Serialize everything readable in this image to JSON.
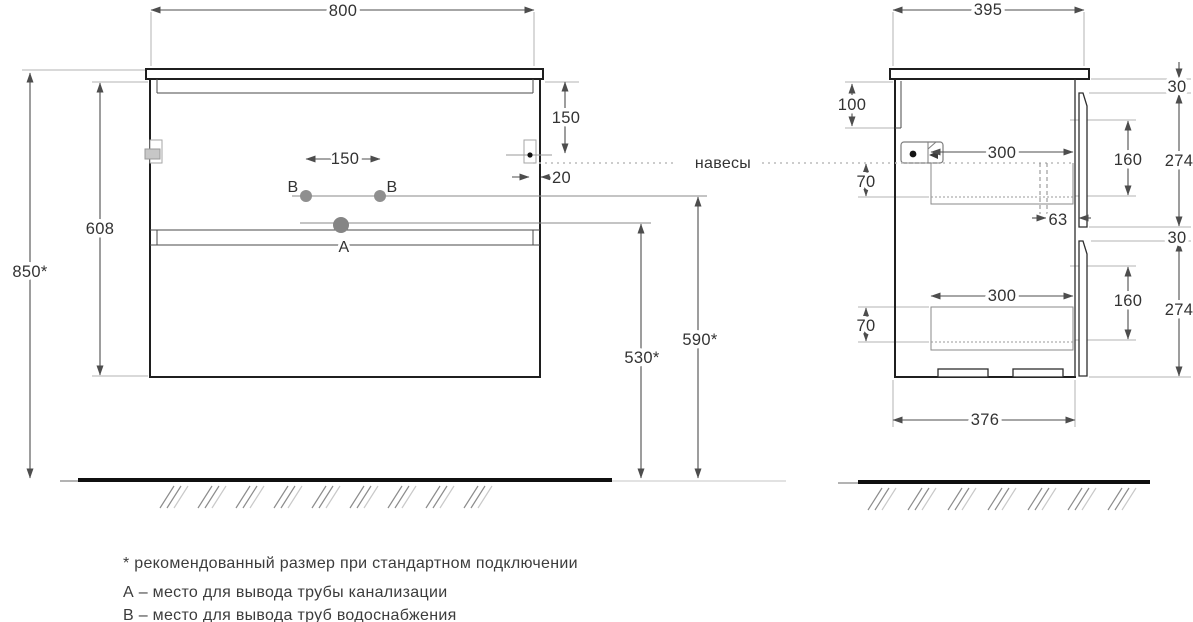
{
  "drawing": {
    "annotations": {
      "hangers": "навесы"
    },
    "front_view": {
      "width": "800",
      "overall_height": "850*",
      "body_height": "608",
      "mount_from_top": "150",
      "mount_from_edge": "20",
      "holes_spacing": "150",
      "hole_b_left": "В",
      "hole_b_right": "В",
      "hole_a": "А",
      "water_outlet_height": "590*",
      "drain_outlet_height": "530*"
    },
    "side_view": {
      "depth": "395",
      "back_rail_height": "100",
      "top_gap": "30",
      "middle_gap": "30",
      "drawer1_front_height": "274",
      "drawer1_inner_height": "160",
      "drawer1_box_height": "70",
      "drawer1_box_depth": "300",
      "siphon_offset": "63",
      "drawer2_front_height": "274",
      "drawer2_inner_height": "160",
      "drawer2_box_height": "70",
      "drawer2_box_depth": "300",
      "bottom_depth": "376"
    },
    "footnotes": [
      "* рекомендованный размер при стандартном подключении",
      "А – место для вывода трубы канализации",
      "В – место для вывода труб водоснабжения"
    ],
    "colors": {
      "object_line": "#1f1f1f",
      "dimension_line": "#4d4d4d",
      "extension_line": "#b3b3b3",
      "text": "#333333",
      "floor": "#101010"
    }
  }
}
